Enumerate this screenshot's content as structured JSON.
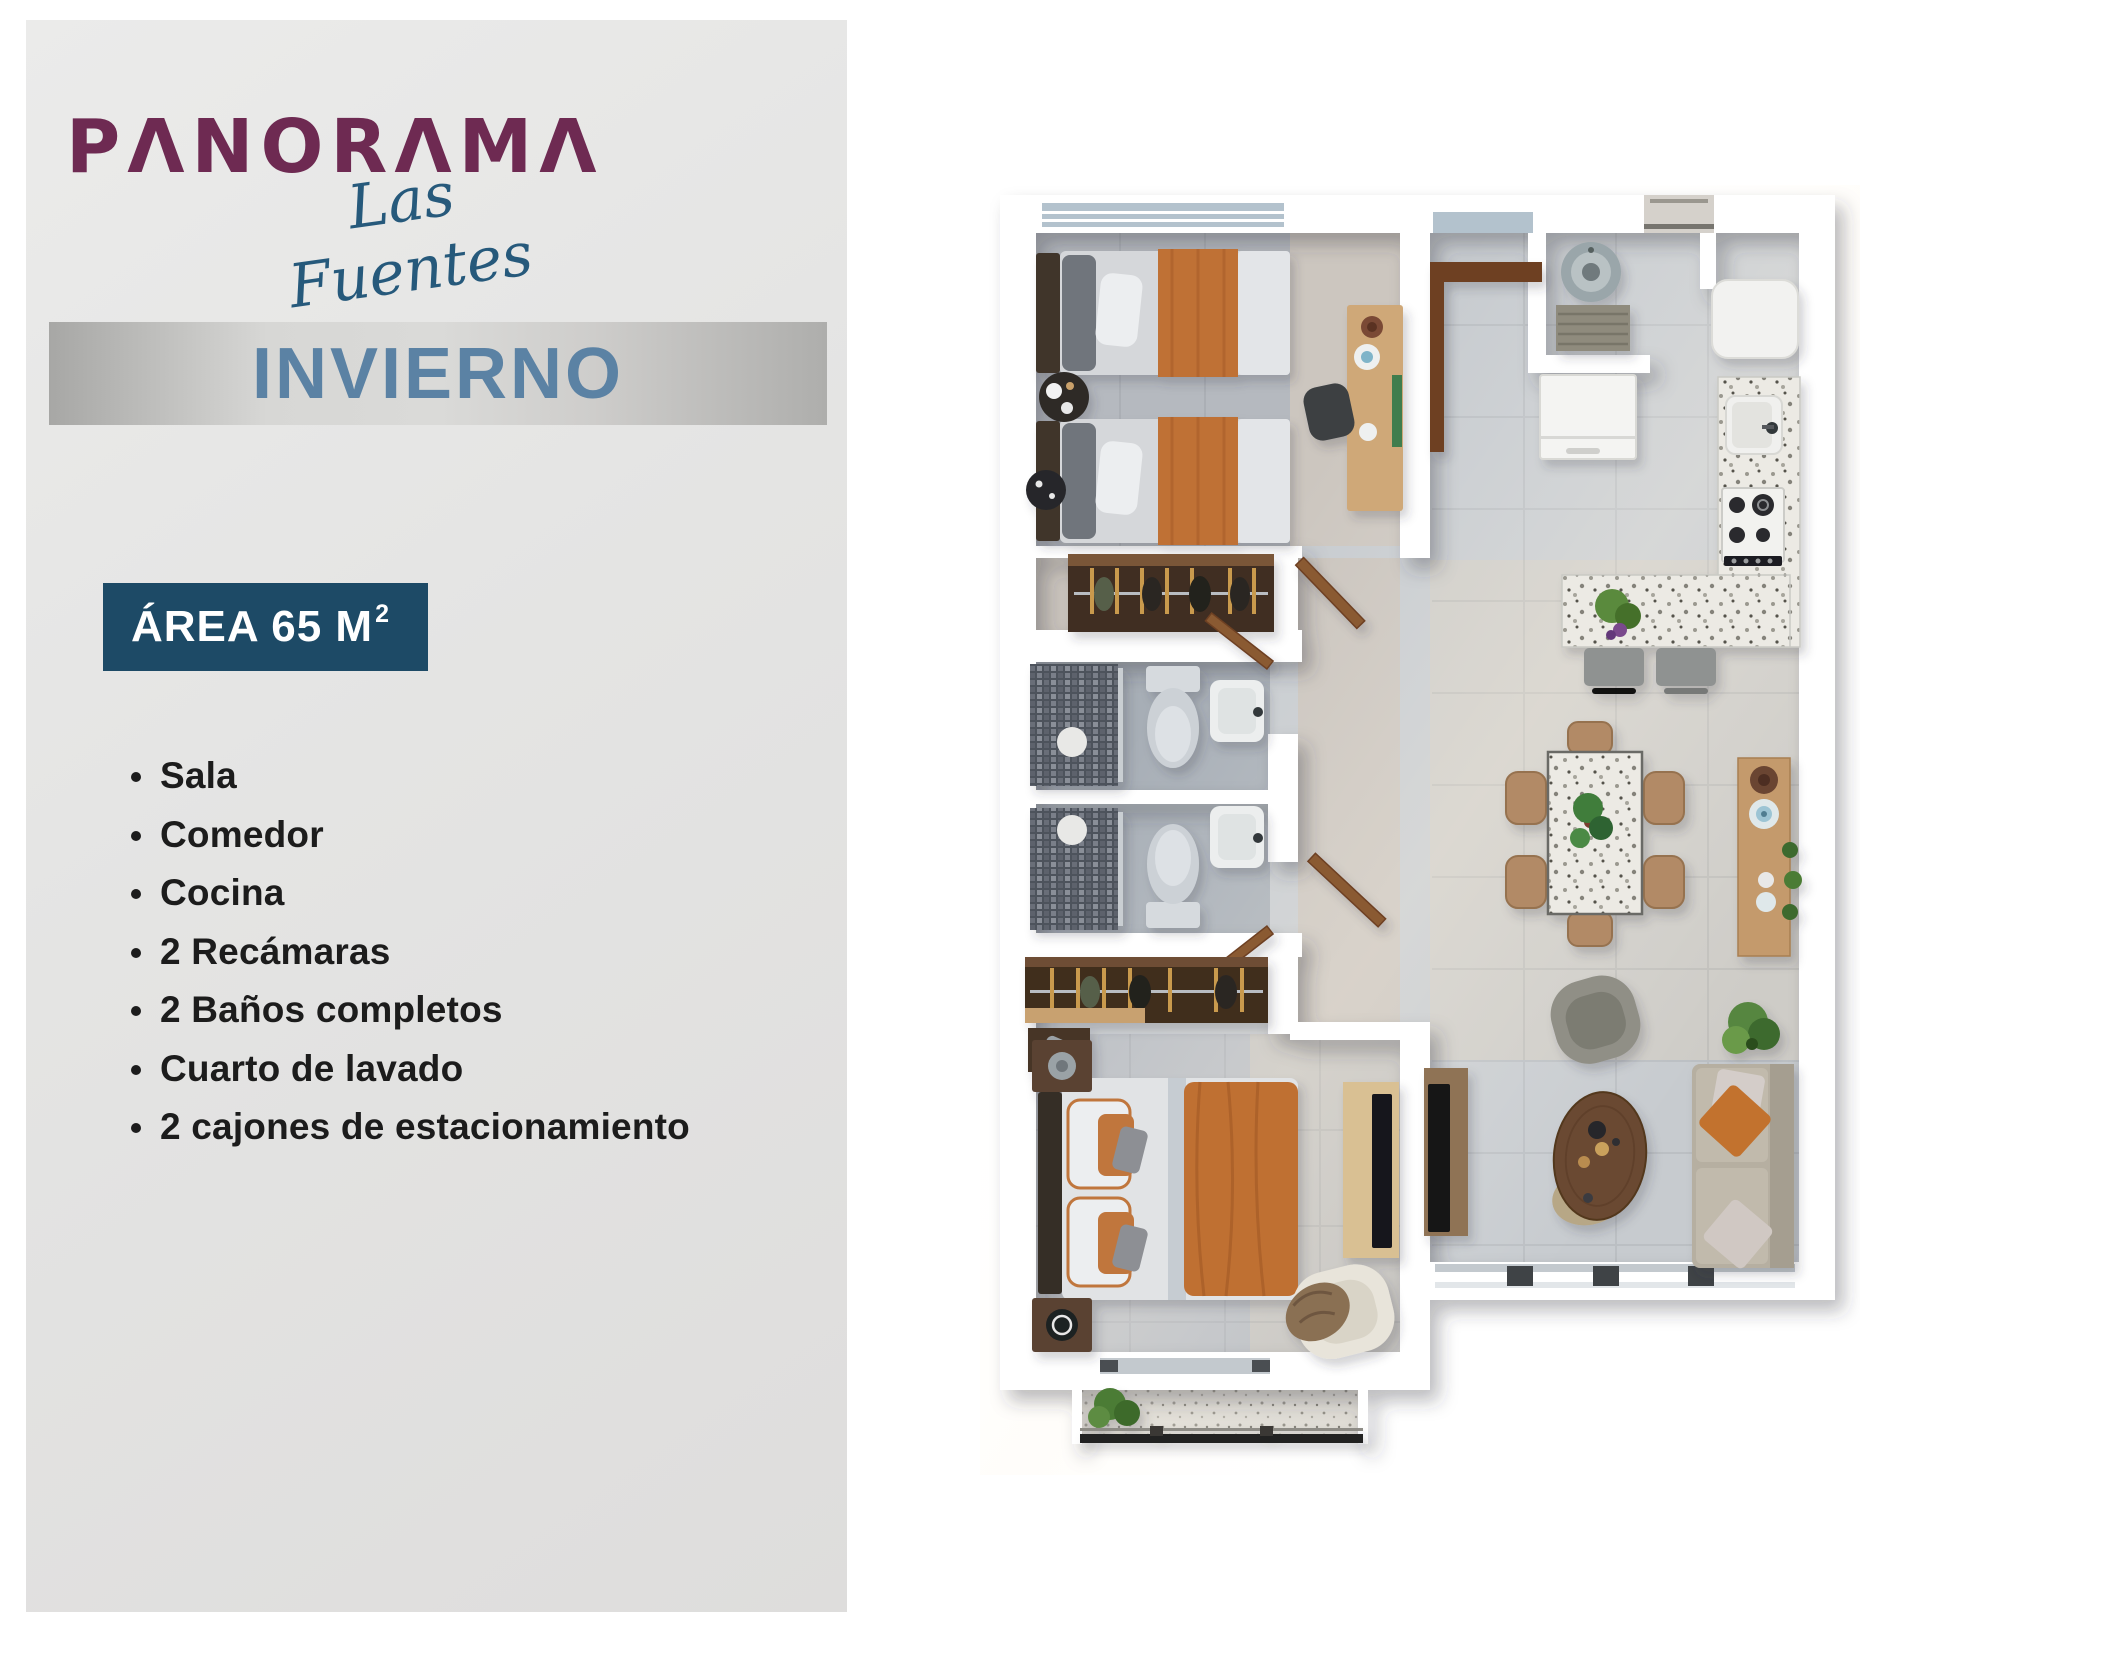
{
  "brand": {
    "name": "PANORAMA",
    "display": "PΛNORΛMΛ",
    "tagline": "Las Fuentes"
  },
  "unit": {
    "model_name": "INVIERNO",
    "area_label": "ÁREA 65 M",
    "area_superscript": "2"
  },
  "features": [
    "Sala",
    "Comedor",
    "Cocina",
    "2 Recámaras",
    "2 Baños completos",
    "Cuarto de lavado",
    "2 cajones de estacionamiento"
  ],
  "palette": {
    "brand": "#6e2a52",
    "tagline": "#26597b",
    "model_text": "#5b82a4",
    "area_banner": "#1d4a66",
    "panel_background": "#e5e5e4",
    "accent_orange": "#bf7136",
    "wall": "#ffffff"
  }
}
